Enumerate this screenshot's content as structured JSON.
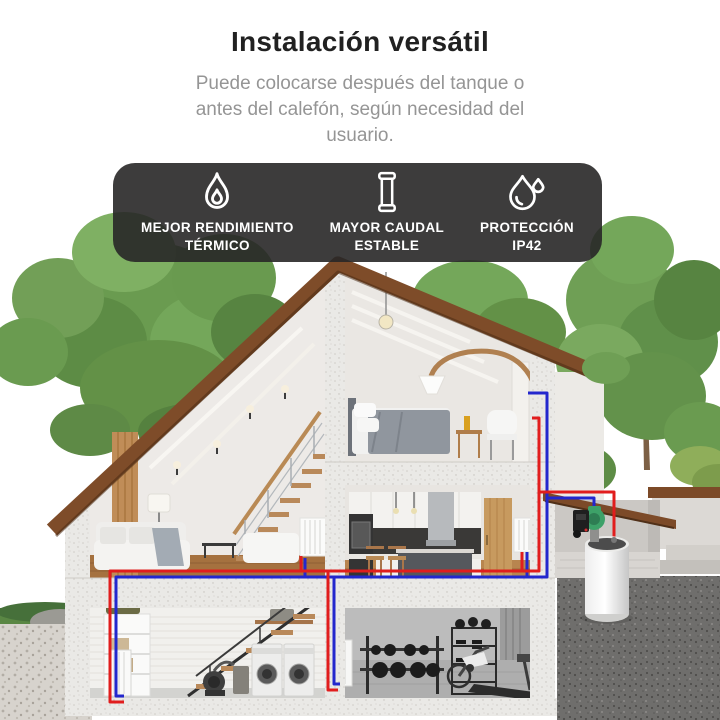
{
  "header": {
    "title": "Instalación versátil",
    "subtitle": "Puede colocarse después del tanque o antes del calefón, según necesidad del usuario."
  },
  "features": [
    {
      "icon": "flame-icon",
      "line1": "MEJOR RENDIMIENTO",
      "line2": "TÉRMICO"
    },
    {
      "icon": "pipe-cartridge-icon",
      "line1": "MAYOR CAUDAL",
      "line2": "ESTABLE"
    },
    {
      "icon": "water-drops-icon",
      "line1": "PROTECCIÓN",
      "line2": "IP42"
    }
  ],
  "colors": {
    "badge_background": "#282727",
    "badge_text": "#ffffff",
    "title_text": "#212121",
    "subtitle_text": "#959595",
    "hot_pipe_red": "#e11d1d",
    "cold_pipe_blue": "#2327cd",
    "pump_green": "#3da168",
    "roof_brown": "#7e4c29",
    "foliage_green": "#6a9b50",
    "tank_white": "#f5f5f5"
  }
}
